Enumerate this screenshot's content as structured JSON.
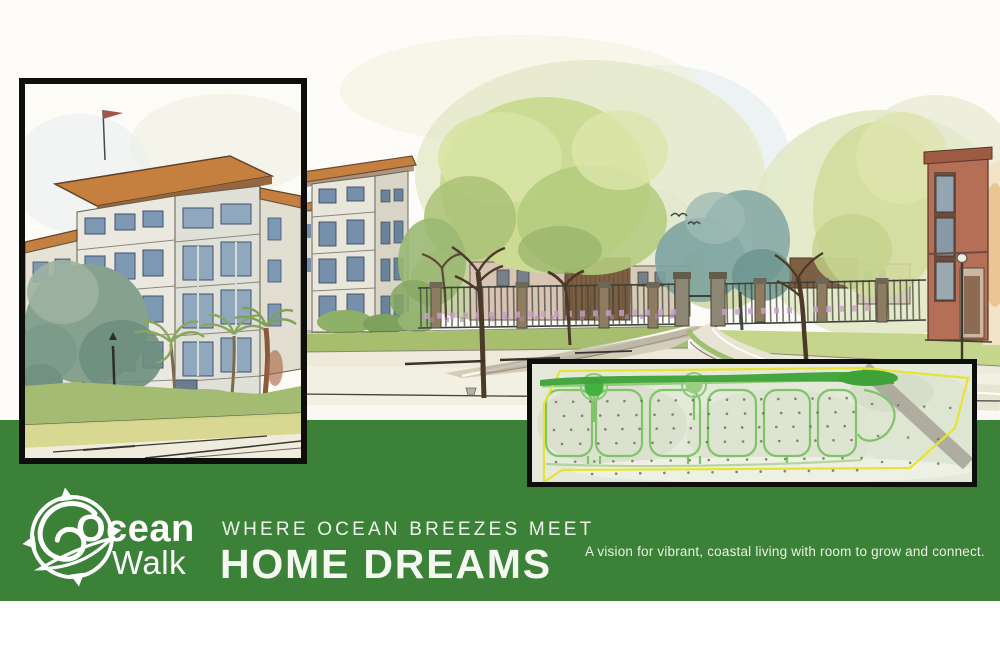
{
  "brand": {
    "name_line1": "Ocean",
    "name_line2": "Walk",
    "logo_icon": "compass-wave-icon"
  },
  "headline": {
    "kicker": "WHERE OCEAN BREEZES MEET",
    "title": "HOME DREAMS"
  },
  "tagline": "A vision for vibrant, coastal living with room to grow and connect.",
  "colors": {
    "brand_green": "#3b8238",
    "text_white": "#ffffff",
    "frame_black": "#0e0e0c",
    "roof_orange": "#c5803f",
    "plan_boundary_yellow": "#e6e334",
    "plan_road_green": "#7fc468",
    "plan_roundabout_green": "#44b23e"
  },
  "illustrations": {
    "main_scene": "watercolor street rendering: four-story buildings, fence with gate, trees, birds",
    "left_inset": "framed watercolor close-up of four-story building with flag, palms and lamp post",
    "plan_inset": "framed aerial site plan with yellow boundary, green loop roads and two roundabouts"
  }
}
